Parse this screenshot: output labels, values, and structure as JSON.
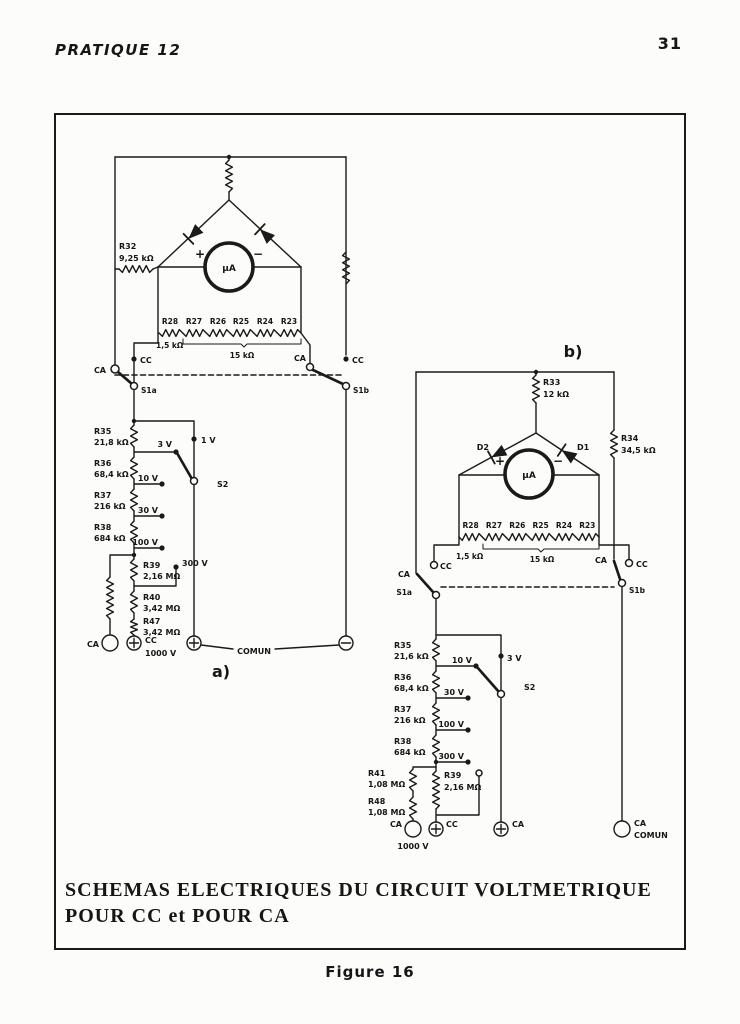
{
  "header": {
    "booklet": "PRATIQUE 12",
    "page": "31"
  },
  "caption": "Figure 16",
  "title_block": {
    "line1": "SCHEMAS ELECTRIQUES DU CIRCUIT VOLTMETRIQUE",
    "line2": "POUR CC et POUR CA"
  },
  "a": {
    "label": "a)",
    "meter": "µA",
    "plus": "+",
    "minus": "−",
    "r32": {
      "name": "R32",
      "value": "9,25 kΩ"
    },
    "bank": {
      "names": [
        "R28",
        "R27",
        "R26",
        "R25",
        "R24",
        "R23"
      ],
      "first_value": "1,5 kΩ",
      "group_value": "15 kΩ"
    },
    "sw": {
      "ca_left": "CA",
      "cc_left": "CC",
      "s1a": "S1a",
      "ca_right": "CA",
      "cc_right": "CC",
      "s1b": "S1b"
    },
    "chain": [
      {
        "name": "R35",
        "value": "21,8 kΩ"
      },
      {
        "name": "R36",
        "value": "68,4 kΩ"
      },
      {
        "name": "R37",
        "value": "216 kΩ"
      },
      {
        "name": "R38",
        "value": "684 kΩ"
      },
      {
        "name": "R39",
        "value": "2,16 MΩ"
      },
      {
        "name": "R40",
        "value": "3,42 MΩ"
      },
      {
        "name": "R47",
        "value": "3,42 MΩ"
      }
    ],
    "taps": {
      "v1": "1 V",
      "v3": "3 V",
      "v10": "10 V",
      "v30": "30 V",
      "v100": "100 V",
      "v300": "300 V",
      "s2": "S2"
    },
    "terminals": {
      "ca": "CA",
      "cc": "CC",
      "cc_value": "1000 V",
      "comun": "COMUN"
    }
  },
  "b": {
    "label": "b)",
    "meter": "µA",
    "plus": "+",
    "minus": "−",
    "r33": {
      "name": "R33",
      "value": "12 kΩ"
    },
    "r34": {
      "name": "R34",
      "value": "34,5 kΩ"
    },
    "d1": "D1",
    "d2": "D2",
    "bank": {
      "names": [
        "R28",
        "R27",
        "R26",
        "R25",
        "R24",
        "R23"
      ],
      "first_value": "1,5 kΩ",
      "group_value": "15 kΩ"
    },
    "sw": {
      "ca_left": "CA",
      "cc_left": "CC",
      "s1a": "S1a",
      "ca_right": "CA",
      "cc_right": "CC",
      "s1b": "S1b"
    },
    "chain": [
      {
        "name": "R35",
        "value": "21,6 kΩ"
      },
      {
        "name": "R36",
        "value": "68,4 kΩ"
      },
      {
        "name": "R37",
        "value": "216 kΩ"
      },
      {
        "name": "R38",
        "value": "684 kΩ"
      },
      {
        "name": "R39",
        "value": "2,16 MΩ"
      }
    ],
    "branch": [
      {
        "name": "R41",
        "value": "1,08 MΩ"
      },
      {
        "name": "R48",
        "value": "1,08 MΩ"
      }
    ],
    "taps": {
      "v3": "3 V",
      "v10": "10 V",
      "v30": "30 V",
      "v100": "100 V",
      "v300": "300 V",
      "s2": "S2"
    },
    "terminals": {
      "ca": "CA",
      "ca_value": "1000 V",
      "cc": "CC",
      "ca2": "CA",
      "comun_line1": "CA",
      "comun_line2": "COMUN"
    }
  }
}
